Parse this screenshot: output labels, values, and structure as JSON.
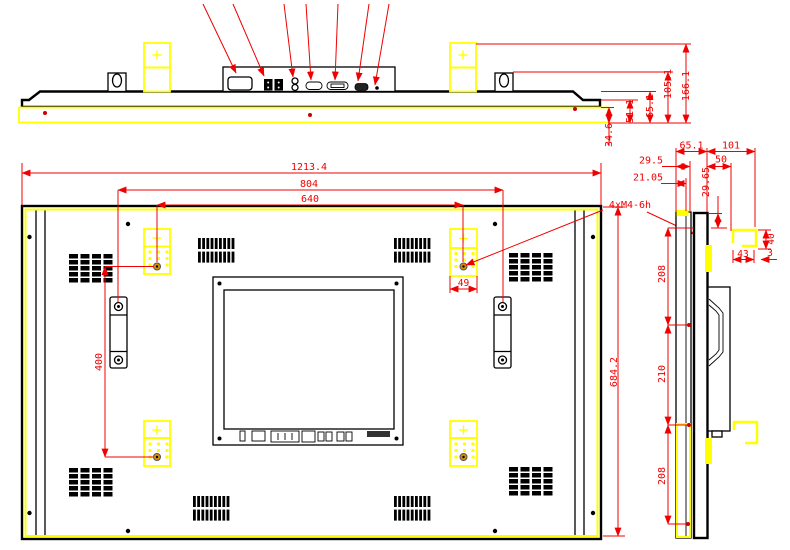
{
  "colors": {
    "dimension": "#f00000",
    "dot": "#cc0000",
    "outline": "#000000",
    "highlight": "#ffff00",
    "hole": "#d89000"
  },
  "views": {
    "top_profile": {
      "dims": {
        "front_step": "34.6",
        "cover_step": "51.1",
        "body_depth": "65.1",
        "clip_height": "105.1",
        "bracket_height": "166.1"
      }
    },
    "rear": {
      "dims": {
        "overall_width": "1213.4",
        "handle_spacing": "804",
        "mount_spacing_x": "640",
        "overall_height": "684.2",
        "mount_spacing_y": "400",
        "bracket_width": "49"
      },
      "thread_note": "4xM4-6h"
    },
    "side_profile": {
      "dims": {
        "panel_depth": "65.1",
        "mount_depth": "101",
        "bezel_depth": "29.5",
        "rear_offset": "50",
        "glass_depth": "21.05",
        "top_offset": "29.65",
        "bracket_height": "40",
        "bracket_depth": "43",
        "bracket_gap": "3",
        "hole_pitch_top": "208",
        "hole_pitch_mid": "210",
        "hole_pitch_bottom": "208"
      }
    }
  }
}
